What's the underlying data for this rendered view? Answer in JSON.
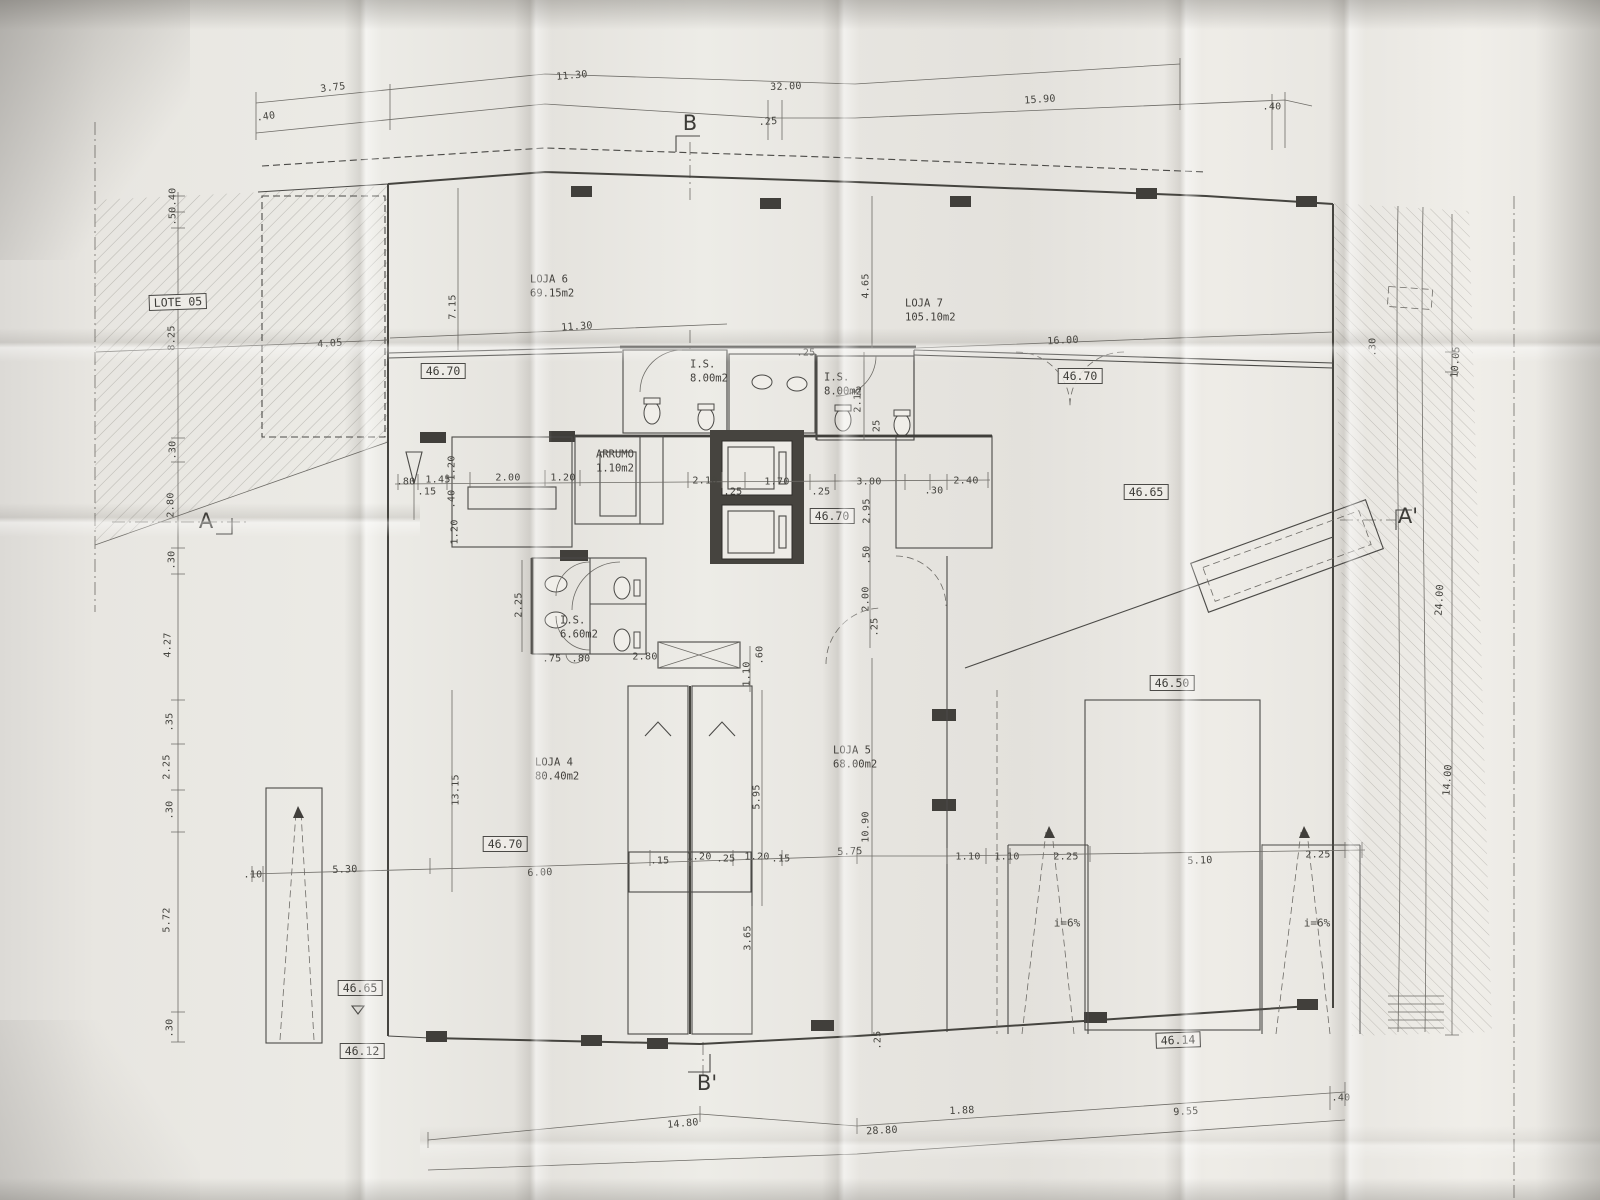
{
  "colors": {
    "paper": "#e9e7e2",
    "ink": "#4b4a47"
  },
  "rooms": [
    {
      "name": "LOJA 6",
      "area": "69.15m2",
      "x": 530,
      "y": 287
    },
    {
      "name": "LOJA 7",
      "area": "105.10m2",
      "x": 905,
      "y": 311
    },
    {
      "name": "LOJA 4",
      "area": "80.40m2",
      "x": 535,
      "y": 770
    },
    {
      "name": "LOJA 5",
      "area": "68.00m2",
      "x": 833,
      "y": 758
    },
    {
      "name": "I.S.",
      "area": "8.00m2",
      "x": 690,
      "y": 372
    },
    {
      "name": "I.S.",
      "area": "8.00m2",
      "x": 824,
      "y": 385
    },
    {
      "name": "I.S.",
      "area": "6.60m2",
      "x": 560,
      "y": 628
    },
    {
      "name": "ARRUMO",
      "area": "1.10m2",
      "x": 596,
      "y": 462
    }
  ],
  "elevations": [
    {
      "v": "LOTE 05",
      "x": 178,
      "y": 302,
      "r": -2
    },
    {
      "v": "46.70",
      "x": 443,
      "y": 371,
      "r": 0
    },
    {
      "v": "46.70",
      "x": 1080,
      "y": 376,
      "r": 0
    },
    {
      "v": "46.70",
      "x": 832,
      "y": 516,
      "r": 0
    },
    {
      "v": "46.65",
      "x": 1146,
      "y": 492,
      "r": 0
    },
    {
      "v": "46.50",
      "x": 1172,
      "y": 683,
      "r": 0
    },
    {
      "v": "46.70",
      "x": 505,
      "y": 844,
      "r": 0
    },
    {
      "v": "46.65",
      "x": 360,
      "y": 988,
      "r": 0
    },
    {
      "v": "46.12",
      "x": 362,
      "y": 1051,
      "r": 0
    },
    {
      "v": "46.14",
      "x": 1178,
      "y": 1040,
      "r": -2
    }
  ],
  "section_markers": [
    {
      "t": "B",
      "x": 690,
      "y": 123
    },
    {
      "t": "B'",
      "x": 707,
      "y": 1083
    },
    {
      "t": "A",
      "x": 206,
      "y": 521
    },
    {
      "t": "A'",
      "x": 1408,
      "y": 516
    }
  ],
  "slope_labels": [
    {
      "t": "i=6%",
      "x": 1067,
      "y": 923
    },
    {
      "t": "i=6%",
      "x": 1317,
      "y": 923
    }
  ],
  "dimensions": [
    {
      "t": ".40",
      "x": 266,
      "y": 117,
      "r": -8
    },
    {
      "t": "3.75",
      "x": 333,
      "y": 88,
      "r": -7
    },
    {
      "t": "11.30",
      "x": 572,
      "y": 76,
      "r": -5
    },
    {
      "t": "32.00",
      "x": 786,
      "y": 87,
      "r": -2
    },
    {
      "t": ".25",
      "x": 768,
      "y": 122,
      "r": -4
    },
    {
      "t": "15.90",
      "x": 1040,
      "y": 100,
      "r": -4
    },
    {
      "t": ".40",
      "x": 1272,
      "y": 107,
      "r": 0
    },
    {
      "t": ".40",
      "x": 173,
      "y": 197,
      "r": -90
    },
    {
      "t": ".50",
      "x": 173,
      "y": 216,
      "r": -90
    },
    {
      "t": "8.25",
      "x": 172,
      "y": 338,
      "r": -90
    },
    {
      "t": "4.05",
      "x": 330,
      "y": 344,
      "r": -4
    },
    {
      "t": "7.15",
      "x": 453,
      "y": 307,
      "r": -90
    },
    {
      "t": "11.30",
      "x": 577,
      "y": 327,
      "r": -4
    },
    {
      "t": "4.65",
      "x": 866,
      "y": 286,
      "r": -90
    },
    {
      "t": "16.00",
      "x": 1063,
      "y": 341,
      "r": -3
    },
    {
      "t": ".25",
      "x": 806,
      "y": 353,
      "r": 0
    },
    {
      "t": "2.15",
      "x": 858,
      "y": 400,
      "r": -90
    },
    {
      "t": ".25",
      "x": 877,
      "y": 429,
      "r": -90
    },
    {
      "t": ".80",
      "x": 406,
      "y": 482,
      "r": 0
    },
    {
      "t": "1.45",
      "x": 438,
      "y": 480,
      "r": 0
    },
    {
      "t": ".15",
      "x": 427,
      "y": 492,
      "r": 0
    },
    {
      "t": "1.20",
      "x": 452,
      "y": 468,
      "r": -90
    },
    {
      "t": "2.00",
      "x": 508,
      "y": 478,
      "r": 0
    },
    {
      "t": "1.20",
      "x": 563,
      "y": 478,
      "r": 0
    },
    {
      "t": "2.10",
      "x": 705,
      "y": 481,
      "r": 0
    },
    {
      "t": ".25",
      "x": 733,
      "y": 492,
      "r": 0
    },
    {
      "t": "1.70",
      "x": 777,
      "y": 482,
      "r": 0
    },
    {
      "t": ".25",
      "x": 821,
      "y": 492,
      "r": 0
    },
    {
      "t": "3.00",
      "x": 869,
      "y": 482,
      "r": 0
    },
    {
      "t": ".30",
      "x": 934,
      "y": 491,
      "r": 0
    },
    {
      "t": "2.40",
      "x": 966,
      "y": 481,
      "r": 0
    },
    {
      "t": ".40",
      "x": 452,
      "y": 499,
      "r": -90
    },
    {
      "t": "1.20",
      "x": 455,
      "y": 532,
      "r": -90
    },
    {
      "t": "2.95",
      "x": 867,
      "y": 511,
      "r": -90
    },
    {
      "t": ".50",
      "x": 867,
      "y": 555,
      "r": -90
    },
    {
      "t": "2.00",
      "x": 866,
      "y": 599,
      "r": -90
    },
    {
      "t": ".25",
      "x": 875,
      "y": 627,
      "r": -90
    },
    {
      "t": ".30",
      "x": 173,
      "y": 450,
      "r": -90
    },
    {
      "t": "2.80",
      "x": 171,
      "y": 505,
      "r": -90
    },
    {
      "t": ".30",
      "x": 172,
      "y": 560,
      "r": -90
    },
    {
      "t": "4.27",
      "x": 168,
      "y": 645,
      "r": -90
    },
    {
      "t": ".35",
      "x": 170,
      "y": 722,
      "r": -90
    },
    {
      "t": "2.25",
      "x": 167,
      "y": 767,
      "r": -90
    },
    {
      "t": ".30",
      "x": 170,
      "y": 810,
      "r": -90
    },
    {
      "t": "5.72",
      "x": 167,
      "y": 920,
      "r": -90
    },
    {
      "t": ".30",
      "x": 170,
      "y": 1028,
      "r": -90
    },
    {
      "t": "2.25",
      "x": 519,
      "y": 605,
      "r": -90
    },
    {
      "t": ".75",
      "x": 552,
      "y": 659,
      "r": 0
    },
    {
      "t": ".80",
      "x": 581,
      "y": 659,
      "r": 0
    },
    {
      "t": "2.80",
      "x": 645,
      "y": 657,
      "r": 0
    },
    {
      "t": ".60",
      "x": 760,
      "y": 655,
      "r": -90
    },
    {
      "t": "1.10",
      "x": 747,
      "y": 674,
      "r": -90
    },
    {
      "t": "5.95",
      "x": 757,
      "y": 797,
      "r": -90
    },
    {
      "t": "3.65",
      "x": 748,
      "y": 938,
      "r": -90
    },
    {
      "t": "13.15",
      "x": 456,
      "y": 790,
      "r": -90
    },
    {
      "t": "10.90",
      "x": 866,
      "y": 827,
      "r": -90
    },
    {
      "t": "6.00",
      "x": 540,
      "y": 873,
      "r": -2
    },
    {
      "t": ".15",
      "x": 660,
      "y": 861,
      "r": 0
    },
    {
      "t": "1.20",
      "x": 699,
      "y": 857,
      "r": 0
    },
    {
      "t": ".25",
      "x": 726,
      "y": 859,
      "r": 0
    },
    {
      "t": "1.20",
      "x": 757,
      "y": 857,
      "r": 0
    },
    {
      "t": ".15",
      "x": 781,
      "y": 859,
      "r": 0
    },
    {
      "t": "5.75",
      "x": 850,
      "y": 852,
      "r": -2
    },
    {
      "t": "1.10",
      "x": 968,
      "y": 857,
      "r": 0
    },
    {
      "t": "1.10",
      "x": 1007,
      "y": 857,
      "r": 0
    },
    {
      "t": "2.25",
      "x": 1066,
      "y": 857,
      "r": 0
    },
    {
      "t": "5.10",
      "x": 1200,
      "y": 861,
      "r": -2
    },
    {
      "t": "2.25",
      "x": 1318,
      "y": 855,
      "r": 0
    },
    {
      "t": "5.30",
      "x": 345,
      "y": 870,
      "r": -2
    },
    {
      "t": ".10",
      "x": 253,
      "y": 875,
      "r": 0
    },
    {
      "t": ".30",
      "x": 1373,
      "y": 347,
      "r": -90
    },
    {
      "t": "10.05",
      "x": 1456,
      "y": 362,
      "r": -86
    },
    {
      "t": "24.00",
      "x": 1440,
      "y": 600,
      "r": -87
    },
    {
      "t": "14.00",
      "x": 1448,
      "y": 780,
      "r": -86
    },
    {
      "t": "14.80",
      "x": 683,
      "y": 1124,
      "r": -5
    },
    {
      "t": "28.80",
      "x": 882,
      "y": 1131,
      "r": -3
    },
    {
      "t": "1.88",
      "x": 962,
      "y": 1111,
      "r": -2
    },
    {
      "t": "9.55",
      "x": 1186,
      "y": 1112,
      "r": -3
    },
    {
      "t": ".40",
      "x": 1341,
      "y": 1098,
      "r": 0
    },
    {
      "t": ".25",
      "x": 878,
      "y": 1040,
      "r": -90
    }
  ]
}
